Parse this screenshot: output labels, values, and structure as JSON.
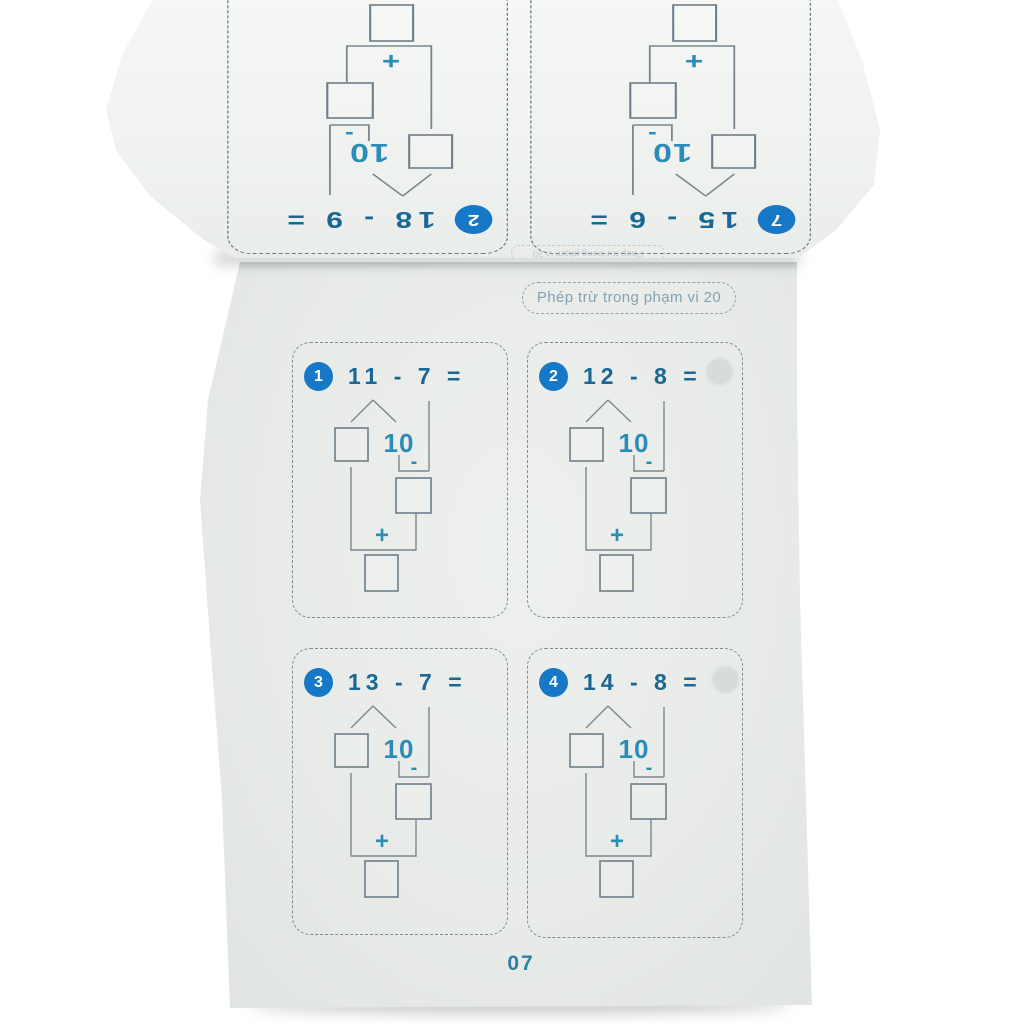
{
  "main_page": {
    "header_badge": "Phép trừ trong phạm vi 20",
    "page_number": "07",
    "exercises": [
      {
        "number": "1",
        "equation": "11 - 7 ="
      },
      {
        "number": "2",
        "equation": "12 - 8 ="
      },
      {
        "number": "3",
        "equation": "13 - 7 ="
      },
      {
        "number": "4",
        "equation": "14 - 8 ="
      }
    ]
  },
  "flipped_page": {
    "header_badge": "Phép trừ trong phạm vi 20",
    "exercises": [
      {
        "number": "7",
        "equation": "15 - 6 ="
      },
      {
        "number": "2",
        "equation": "18 - 9 ="
      }
    ]
  },
  "diagram_labels": {
    "ten": "10",
    "minus": "-",
    "plus": "+"
  },
  "colors": {
    "badge_blue": "#1878c8",
    "equation_teal": "#1a6795",
    "accent_teal": "#2b8cb8",
    "diagram_line_gray": "#7b878f",
    "page_number_teal": "#2f7fa5"
  }
}
